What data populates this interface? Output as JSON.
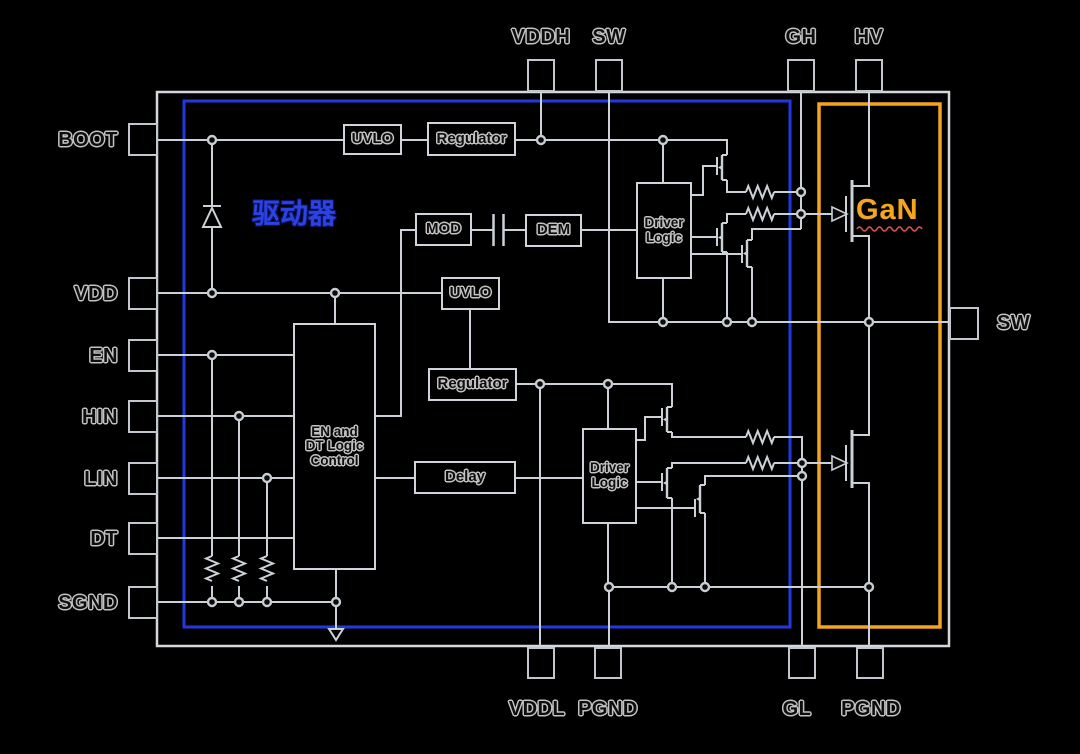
{
  "pins": {
    "top": [
      {
        "label": "VDDH"
      },
      {
        "label": "SW"
      },
      {
        "label": "GH"
      },
      {
        "label": "HV"
      }
    ],
    "left": [
      {
        "label": "BOOT"
      },
      {
        "label": "VDD"
      },
      {
        "label": "EN"
      },
      {
        "label": "HIN"
      },
      {
        "label": "LIN"
      },
      {
        "label": "DT"
      },
      {
        "label": "SGND"
      }
    ],
    "right": [
      {
        "label": "SW"
      }
    ],
    "bottom": [
      {
        "label": "VDDL"
      },
      {
        "label": "PGND"
      },
      {
        "label": "GL"
      },
      {
        "label": "PGND"
      }
    ]
  },
  "blocks": {
    "uvlo_high": "UVLO",
    "regulator_high": "Regulator",
    "mod": "MOD",
    "dem": "DEM",
    "uvlo_low": "UVLO",
    "regulator_low": "Regulator",
    "en_dt_logic": "EN and\nDT Logic\nControl",
    "delay": "Delay",
    "driver_logic_high": "Driver\nLogic",
    "driver_logic_low": "Driver\nLogic"
  },
  "region_labels": {
    "driver_zh": "驱动器",
    "gan": "GaN"
  },
  "colors": {
    "background": "#000000",
    "wire": "#ccd1d7",
    "driver_region_border": "#2438e0",
    "gan_region_border": "#f3a51d",
    "driver_label": "#2c43e0",
    "gan_label": "#f5a61e",
    "squiggle": "#d85555"
  }
}
